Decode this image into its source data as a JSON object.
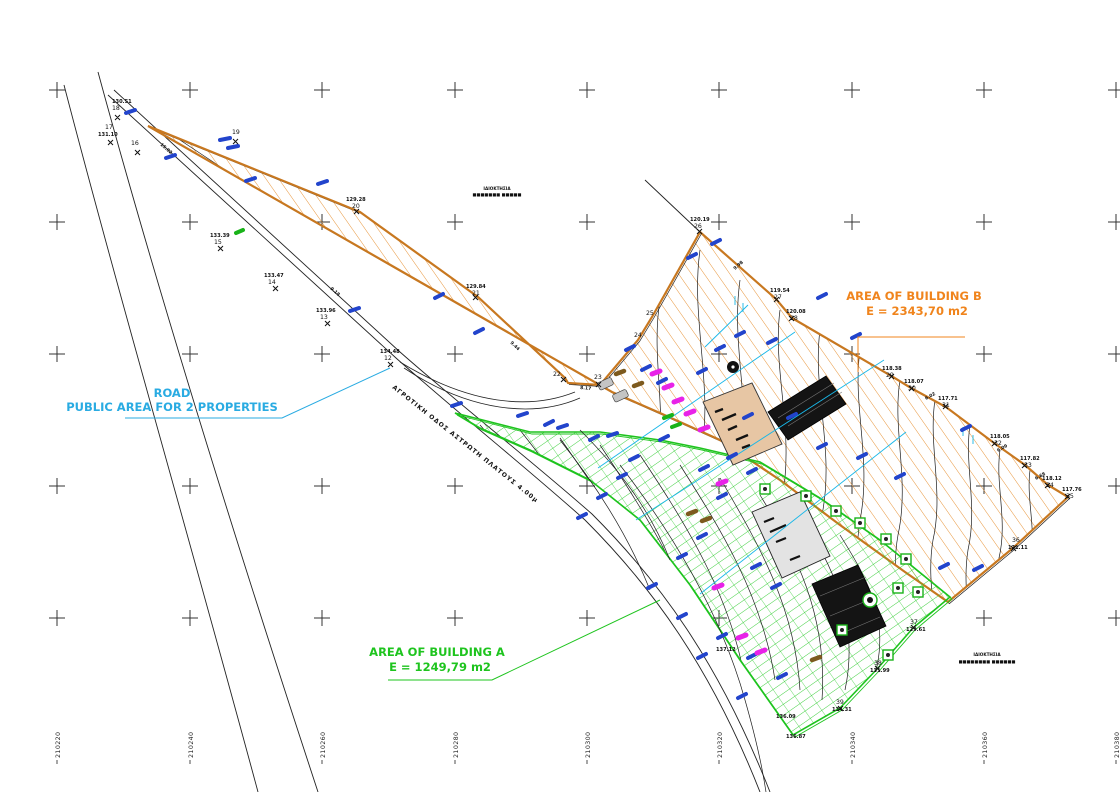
{
  "labels": {
    "building_b": {
      "line1": "AREA OF BUILDING B",
      "line2": "E = 2343,70 m2",
      "color": "#F0841C"
    },
    "building_a": {
      "line1": "AREA OF BUILDING A",
      "line2": "E = 1249,79 m2",
      "color": "#1EC41E"
    },
    "road": {
      "line1": "ROAD",
      "line2": "PUBLIC AREA FOR 2 PROPERTIES",
      "color": "#29ABE2"
    }
  },
  "road_name": "ΑΓΡΟΤΙΚΗ ΟΔΟΣ ΑΣΤΡΩΤΗ ΠΛΑΤΟΥΣ 4.00μ",
  "adjacent_property_note_top": {
    "line1": "ΙΔΙΟΚΤΗΣΙΑ",
    "line2": "■■■■■■■ ■■■■■"
  },
  "adjacent_property_note_bottom": {
    "line1": "ΙΔΙΟΚΤΗΣΙΑ",
    "line2": "■■■■■■■■ ■■■■■■"
  },
  "coordinates": [
    "210220",
    "210240",
    "210260",
    "210280",
    "210300",
    "210320",
    "210340",
    "210360",
    "210380"
  ],
  "points": [
    {
      "t": "130.51",
      "b": "18"
    },
    {
      "t": "17",
      "b": "131.10"
    },
    {
      "t": "16",
      "b": ""
    },
    {
      "t": "19",
      "b": ""
    },
    {
      "t": "133.39",
      "b": "15"
    },
    {
      "t": "133.47",
      "b": "14"
    },
    {
      "t": "133.96",
      "b": "13"
    },
    {
      "t": "134.48",
      "b": "12"
    },
    {
      "t": "129.28",
      "b": "20"
    },
    {
      "t": "129.84",
      "b": "21"
    },
    {
      "t": "22",
      "b": ""
    },
    {
      "t": "23",
      "b": ""
    },
    {
      "t": "24",
      "b": ""
    },
    {
      "t": "25",
      "b": ""
    },
    {
      "t": "120.19",
      "b": "26"
    },
    {
      "t": "119.54",
      "b": "27"
    },
    {
      "t": "120.08",
      "b": "28"
    },
    {
      "t": "118.38",
      "b": "29"
    },
    {
      "t": "118.07",
      "b": "30"
    },
    {
      "t": "117.71",
      "b": "31"
    },
    {
      "t": "118.05",
      "b": "32"
    },
    {
      "t": "117.82",
      "b": "33"
    },
    {
      "t": "118.12",
      "b": "34"
    },
    {
      "t": "117.76",
      "b": "35"
    },
    {
      "t": "36",
      "b": "121.11"
    },
    {
      "t": "37",
      "b": "129.61"
    },
    {
      "t": "38",
      "b": "131.99"
    },
    {
      "t": "39",
      "b": "134.31"
    },
    {
      "t": "136.09",
      "b": ""
    },
    {
      "t": "136.87",
      "b": ""
    },
    {
      "t": "137.12",
      "b": ""
    }
  ],
  "distances": [
    {
      "t": "15.02"
    },
    {
      "t": "9.18"
    },
    {
      "t": "9.44"
    },
    {
      "t": "8.17"
    },
    {
      "t": "9.98"
    },
    {
      "t": "6.02"
    },
    {
      "t": "6.09"
    },
    {
      "t": "6.68"
    }
  ]
}
